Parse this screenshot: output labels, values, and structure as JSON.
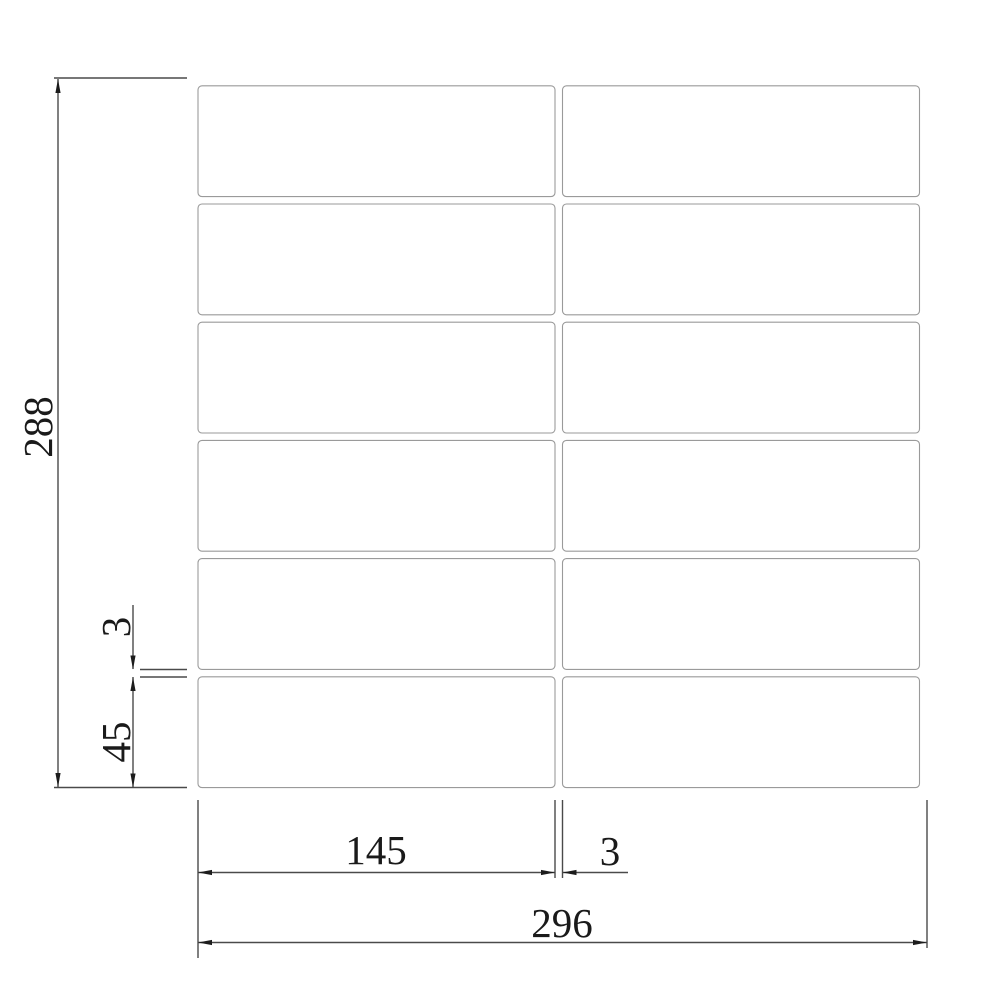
{
  "drawing": {
    "title": "tile-sheet-dimension-drawing",
    "grid": {
      "rows": 6,
      "columns": 2
    },
    "dimensions": {
      "overall_height": "288",
      "overall_width": "296",
      "tile_width": "145",
      "tile_height": "45",
      "gap_vertical": "3",
      "gap_horizontal": "3"
    },
    "colors": {
      "tile_outline": "#9a9a9a",
      "dimension_line": "#4a4a4a",
      "text": "#1a1a1a",
      "background": "#ffffff"
    }
  }
}
